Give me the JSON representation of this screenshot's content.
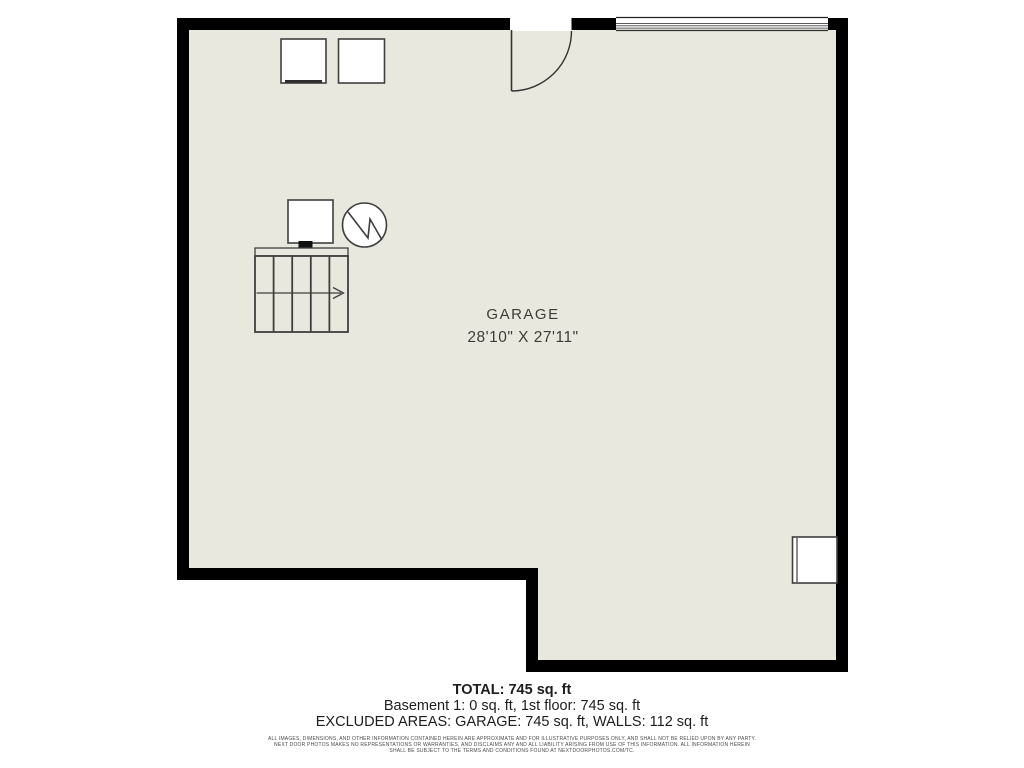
{
  "floorplan": {
    "room_label": "GARAGE",
    "room_dimensions": "28'10\" X 27'11\"",
    "symbols": [
      "appliance-left",
      "appliance-right",
      "entry-door-swing",
      "garage-door",
      "furnace",
      "water-heater",
      "stairs-with-direction-arrow",
      "wall-appliance"
    ],
    "colors": {
      "floor": "#e9e8df",
      "walls": "#000000",
      "symbol_lines": "#3f3f3f",
      "page_background": "#ffffff"
    }
  },
  "summary": {
    "total": "TOTAL: 745 sq. ft",
    "floors": "Basement 1: 0 sq. ft, 1st floor: 745 sq. ft",
    "excluded": "EXCLUDED AREAS: GARAGE: 745 sq. ft, WALLS: 112 sq. ft"
  },
  "disclaimer": {
    "line1": "ALL IMAGES, DIMENSIONS, AND OTHER INFORMATION CONTAINED HEREIN ARE APPROXIMATE AND FOR ILLUSTRATIVE PURPOSES ONLY, AND SHALL NOT BE RELIED UPON BY ANY PARTY.",
    "line2": "NEXT DOOR PHOTOS MAKES NO REPRESENTATIONS OR WARRANTIES, AND DISCLAIMS ANY AND ALL LIABILITY ARISING FROM USE OF THIS INFORMATION. ALL INFORMATION HEREIN",
    "line3": "SHALL BE SUBJECT TO THE TERMS AND CONDITIONS FOUND AT NEXTDOORPHOTOS.COM/TC."
  }
}
